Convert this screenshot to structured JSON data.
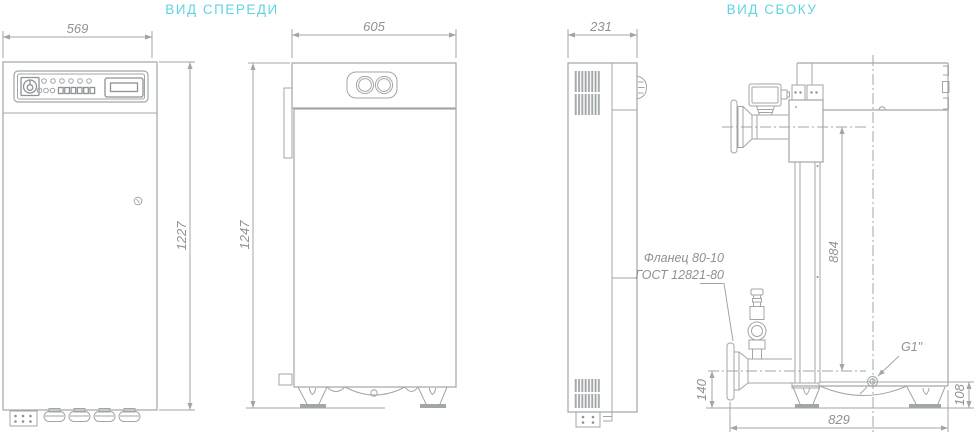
{
  "titles": {
    "front_view": "ВИД СПЕРЕДИ",
    "side_view": "ВИД СБОКУ"
  },
  "dimensions": {
    "cabinet_width": "569",
    "cabinet_height": "1227",
    "boiler_width": "605",
    "boiler_height": "1247",
    "cabinet_depth": "231",
    "supply_axis_height": "884",
    "return_axis_height": "140",
    "g1_height": "108",
    "overall_depth": "829"
  },
  "labels": {
    "flange_line1": "Фланец 80-10",
    "flange_line2": "ГОСТ 12821-80",
    "g1_connection": "G1\""
  },
  "colors": {
    "line": "#a1a6a9",
    "line_dark": "#8d9295",
    "accent": "#5ed5e4",
    "dim_text": "#8d9295"
  }
}
